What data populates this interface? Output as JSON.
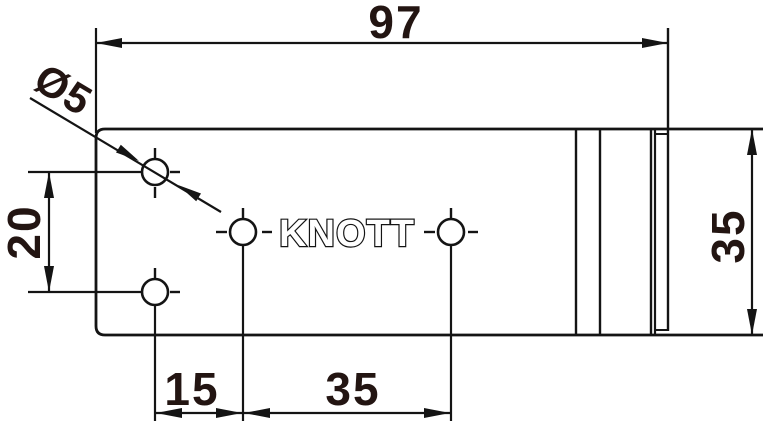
{
  "drawing": {
    "brand": "KNOTT",
    "dimensions": {
      "top_width": "97",
      "hole_diameter": "Ø5",
      "left_hole_spacing": "20",
      "right_height": "35",
      "bottom_spacing_left": "15",
      "bottom_spacing_right": "35"
    },
    "colors": {
      "line": "#141414",
      "dimension_text": "#231512",
      "background": "#ffffff"
    }
  }
}
